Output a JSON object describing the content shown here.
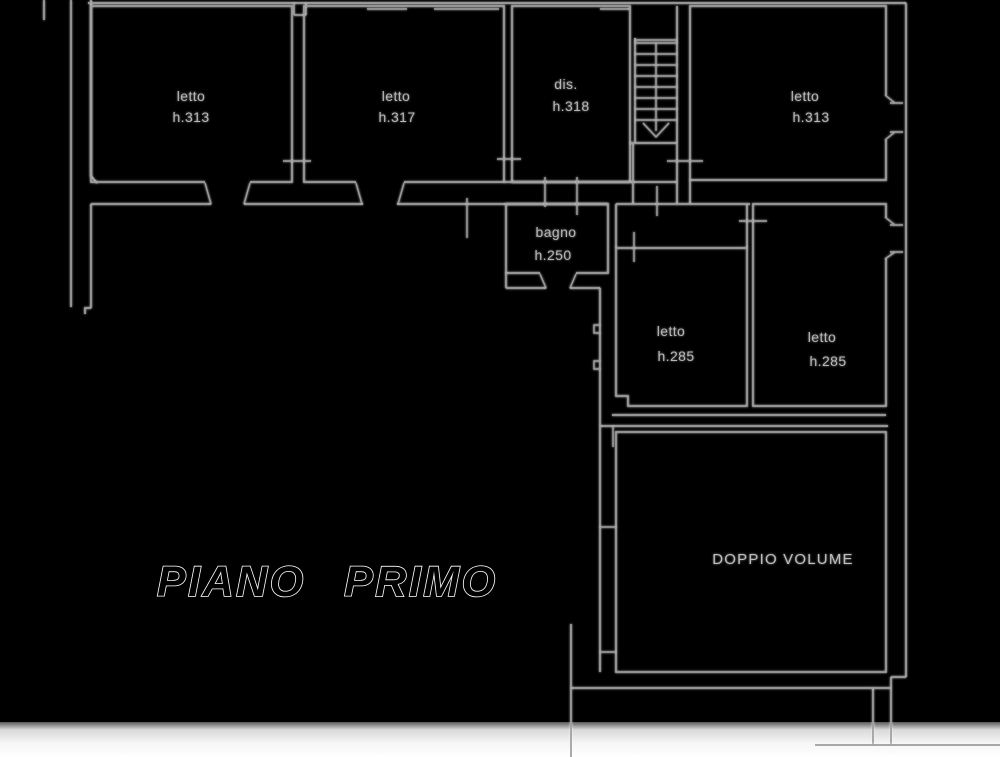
{
  "title": {
    "text": "PIANO PRIMO"
  },
  "plan": {
    "rooms": [
      {
        "id": "letto-nw",
        "name": "letto",
        "height": "h.313"
      },
      {
        "id": "letto-n",
        "name": "letto",
        "height": "h.317"
      },
      {
        "id": "dis",
        "name": "dis.",
        "height": "h.318"
      },
      {
        "id": "letto-ne",
        "name": "letto",
        "height": "h.313"
      },
      {
        "id": "bagno",
        "name": "bagno",
        "height": "h.250"
      },
      {
        "id": "letto-c",
        "name": "letto",
        "height": "h.285"
      },
      {
        "id": "letto-e",
        "name": "letto",
        "height": "h.285"
      },
      {
        "id": "doppio-volume",
        "name": "DOPPIO VOLUME",
        "height": ""
      }
    ],
    "features": [
      "staircase-with-down-arrow",
      "door-openings",
      "window-symbols"
    ]
  },
  "colors": {
    "background": "#000000",
    "wall_line": "#9c9c9c",
    "room_label": "#b6b6b6",
    "title_fill": "#000000",
    "title_outline": "#ffffff",
    "bottom_strip": "#ffffff"
  }
}
